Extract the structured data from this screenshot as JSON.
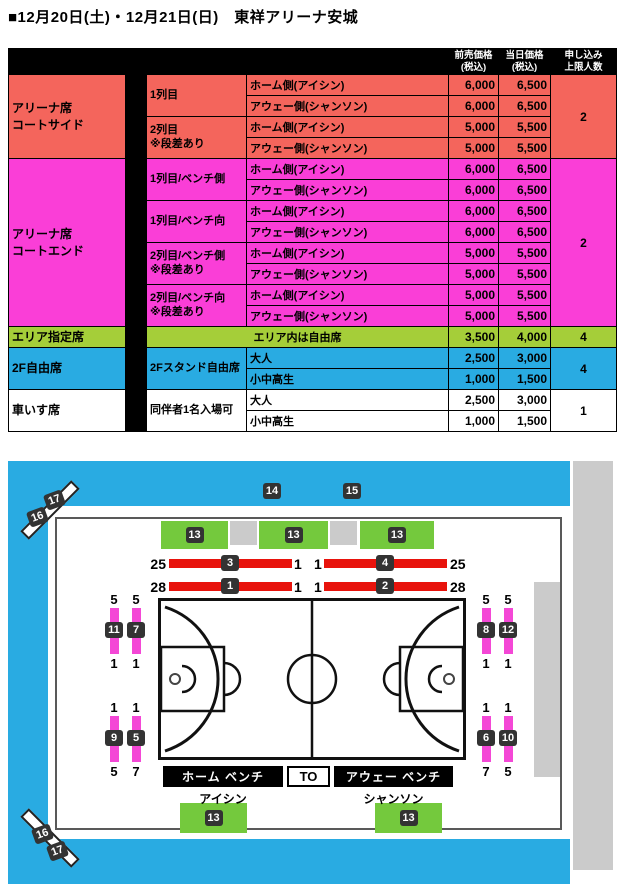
{
  "title": "■12月20日(土)・12月21日(日)　東祥アリーナ安城",
  "colors": {
    "salmon": "#F4655C",
    "magenta": "#FA3ED7",
    "green_table": "#A5CE39",
    "blue": "#29ABE2",
    "map_green": "#74C93D",
    "red_bar": "#E8130C",
    "pink_strip": "#F447D6",
    "badge_dark": "#333333",
    "gray_block": "#CBCBCB"
  },
  "table": {
    "header": {
      "advance": "前売価格\n(税込)",
      "day": "当日価格\n(税込)",
      "limit": "申し込み\n上限人数"
    },
    "groups": [
      {
        "name": "アリーナ席\nコートサイド",
        "limit": "2"
      },
      {
        "name": "アリーナ席\nコートエンド",
        "limit": "2"
      },
      {
        "name": "エリア指定席",
        "limit": "4"
      },
      {
        "name": "2F自由席",
        "limit": "4"
      },
      {
        "name": "車いす席",
        "limit": "1"
      }
    ],
    "descs": [
      "1列目",
      "2列目\n※段差あり",
      "1列目/ベンチ側",
      "1列目/ベンチ向",
      "2列目/ベンチ側\n※段差あり",
      "2列目/ベンチ向\n※段差あり",
      "2Fスタンド自由席",
      "同伴者1名入場可"
    ],
    "area_note": "エリア内は自由席",
    "rows": [
      {
        "num": "1",
        "side": "ホーム側(アイシン)",
        "advance": "6,000",
        "day": "6,500"
      },
      {
        "num": "2",
        "side": "アウェー側(シャンソン)",
        "advance": "6,000",
        "day": "6,500"
      },
      {
        "num": "3",
        "side": "ホーム側(アイシン)",
        "advance": "5,000",
        "day": "5,500"
      },
      {
        "num": "4",
        "side": "アウェー側(シャンソン)",
        "advance": "5,000",
        "day": "5,500"
      },
      {
        "num": "5",
        "side": "ホーム側(アイシン)",
        "advance": "6,000",
        "day": "6,500"
      },
      {
        "num": "6",
        "side": "アウェー側(シャンソン)",
        "advance": "6,000",
        "day": "6,500"
      },
      {
        "num": "7",
        "side": "ホーム側(アイシン)",
        "advance": "6,000",
        "day": "6,500"
      },
      {
        "num": "8",
        "side": "アウェー側(シャンソン)",
        "advance": "6,000",
        "day": "6,500"
      },
      {
        "num": "9",
        "side": "ホーム側(アイシン)",
        "advance": "5,000",
        "day": "5,500"
      },
      {
        "num": "10",
        "side": "アウェー側(シャンソン)",
        "advance": "5,000",
        "day": "5,500"
      },
      {
        "num": "11",
        "side": "ホーム側(アイシン)",
        "advance": "5,000",
        "day": "5,500"
      },
      {
        "num": "12",
        "side": "アウェー側(シャンソン)",
        "advance": "5,000",
        "day": "5,500"
      },
      {
        "num": "13",
        "side": "",
        "advance": "3,500",
        "day": "4,000"
      },
      {
        "num": "14",
        "side": "大人",
        "advance": "2,500",
        "day": "3,000"
      },
      {
        "num": "15",
        "side": "小中高生",
        "advance": "1,000",
        "day": "1,500"
      },
      {
        "num": "16",
        "side": "大人",
        "advance": "2,500",
        "day": "3,000"
      },
      {
        "num": "17",
        "side": "小中高生",
        "advance": "1,000",
        "day": "1,500"
      }
    ]
  },
  "map": {
    "upper_badges": [
      "14",
      "15"
    ],
    "top_blocks": [
      "13",
      "13",
      "13"
    ],
    "bottom_blocks": [
      "13",
      "13"
    ],
    "red_rows": [
      {
        "l_out": "25",
        "l_badge": "3",
        "l_in": "1",
        "r_in": "1",
        "r_badge": "4",
        "r_out": "25"
      },
      {
        "l_out": "28",
        "l_badge": "1",
        "l_in": "1",
        "r_in": "1",
        "r_badge": "2",
        "r_out": "28"
      }
    ],
    "pink_groups": {
      "left_top": {
        "top": [
          "5",
          "5"
        ],
        "badges": [
          "11",
          "7"
        ],
        "bottom": [
          "1",
          "1"
        ]
      },
      "left_bottom": {
        "top": [
          "1",
          "1"
        ],
        "badges": [
          "9",
          "5"
        ],
        "bottom": [
          "5",
          "7"
        ]
      },
      "right_top": {
        "top": [
          "5",
          "5"
        ],
        "badges": [
          "8",
          "12"
        ],
        "bottom": [
          "1",
          "1"
        ]
      },
      "right_bottom": {
        "top": [
          "1",
          "1"
        ],
        "badges": [
          "6",
          "10"
        ],
        "bottom": [
          "7",
          "5"
        ]
      }
    },
    "bench": {
      "home": "ホーム ベンチ",
      "to": "TO",
      "away": "アウェー ベンチ"
    },
    "teams": {
      "home": "アイシン",
      "away": "シャンソン"
    },
    "corner_markers": {
      "top": [
        "17",
        "16"
      ],
      "bottom": [
        "16",
        "17"
      ]
    }
  }
}
